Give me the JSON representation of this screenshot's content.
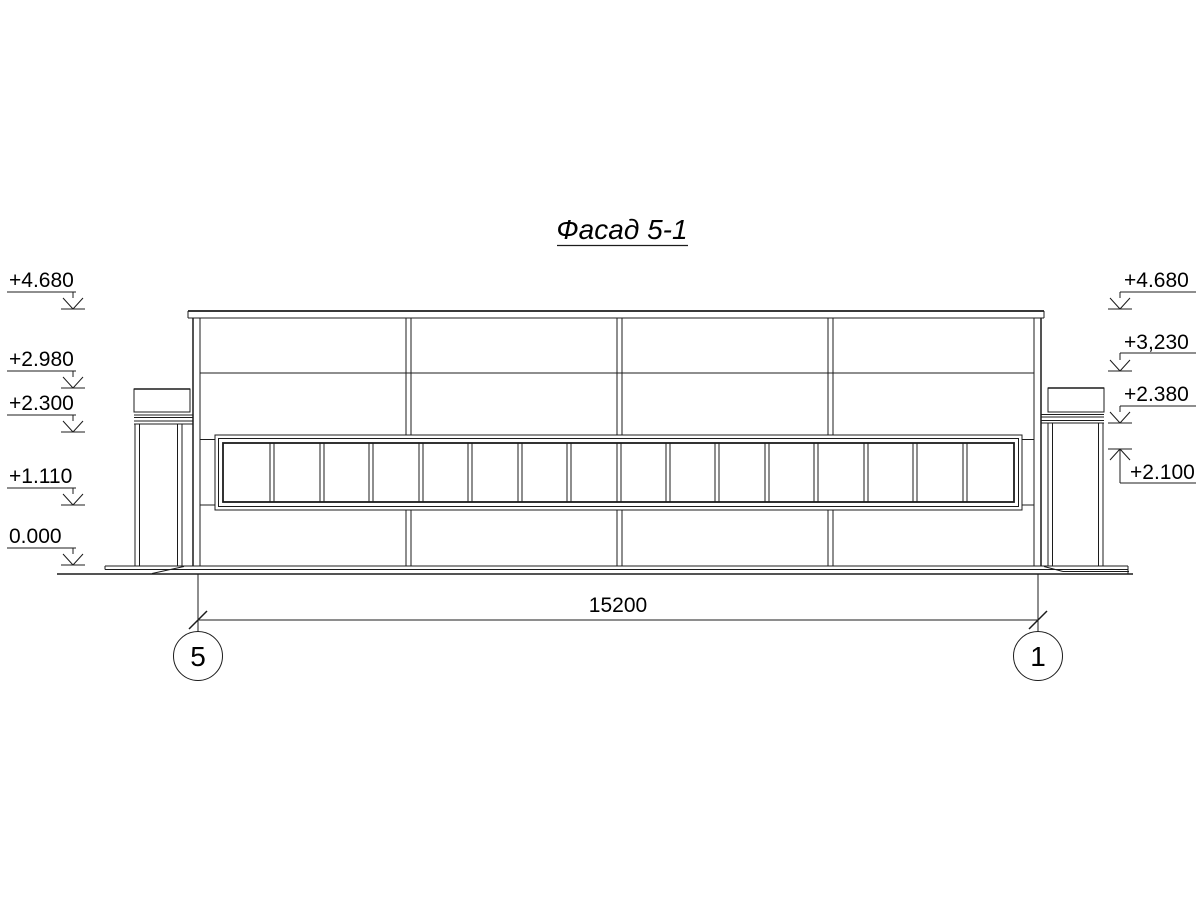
{
  "drawing": {
    "title": "Фасад 5-1",
    "elevation_marks_left": [
      {
        "label": "+4.680"
      },
      {
        "label": "+2.980"
      },
      {
        "label": "+2.300"
      },
      {
        "label": "+1.110"
      },
      {
        "label": "0.000"
      }
    ],
    "elevation_marks_right": [
      {
        "label": "+4.680"
      },
      {
        "label": "+3,230"
      },
      {
        "label": "+2.380"
      },
      {
        "label": "+2.100"
      }
    ],
    "dimension": {
      "value": "15200"
    },
    "axes": [
      {
        "label": "5"
      },
      {
        "label": "1"
      }
    ],
    "colors": {
      "line": "#1c1c1c",
      "background": "#ffffff"
    }
  }
}
